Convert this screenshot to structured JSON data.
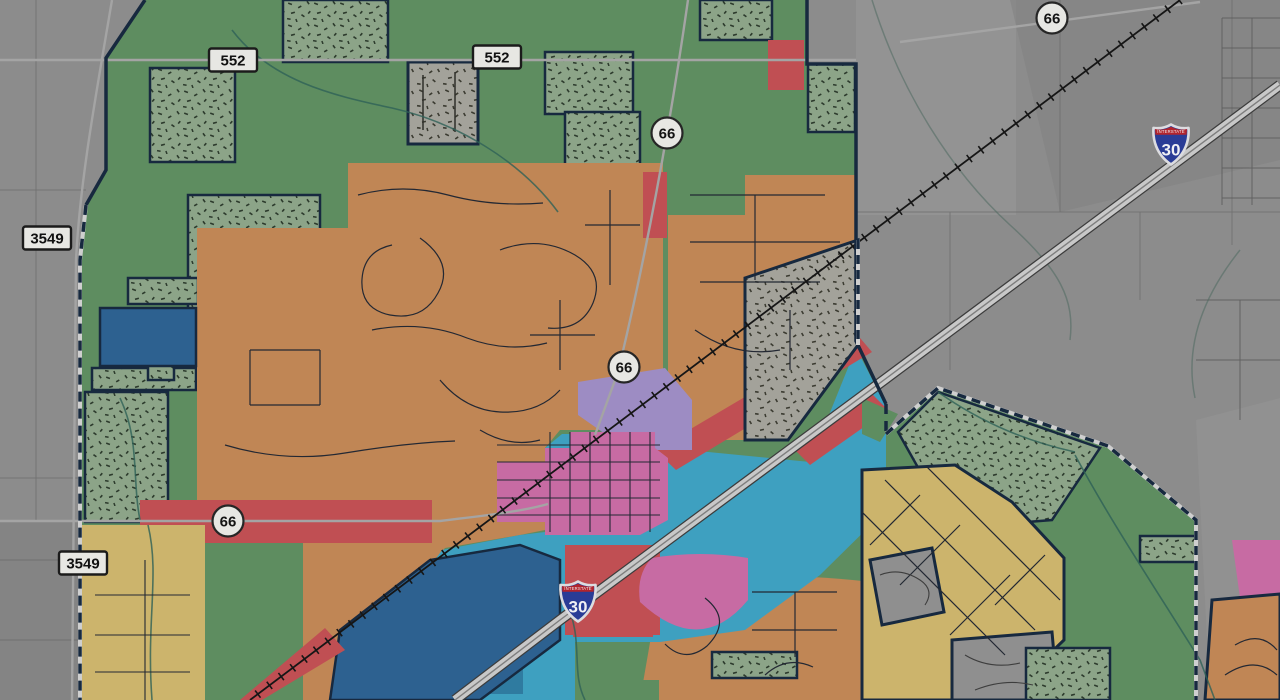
{
  "map": {
    "kind": "municipal zoning map over aerial imagery",
    "canvas": {
      "width": 1280,
      "height": 700
    },
    "highway_shields": {
      "rectangular": [
        {
          "label": "552",
          "x": 233,
          "y": 60
        },
        {
          "label": "552",
          "x": 497,
          "y": 57
        },
        {
          "label": "3549",
          "x": 47,
          "y": 238
        },
        {
          "label": "3549",
          "x": 83,
          "y": 563
        }
      ],
      "circular": [
        {
          "label": "66",
          "x": 1052,
          "y": 18
        },
        {
          "label": "66",
          "x": 667,
          "y": 133
        },
        {
          "label": "66",
          "x": 624,
          "y": 367
        },
        {
          "label": "66",
          "x": 228,
          "y": 521
        }
      ],
      "interstate": [
        {
          "label": "30",
          "caption": "INTERSTATE",
          "x": 1171,
          "y": 144
        },
        {
          "label": "30",
          "caption": "INTERSTATE",
          "x": 578,
          "y": 601
        }
      ]
    },
    "palette": {
      "aerial_gray": "#8c8c8c",
      "zone_green": "#5e8d60",
      "zone_green_speckled_base": "#8ca488",
      "zone_gray_speckled_base": "#a3a29a",
      "zone_orange": "#c08655",
      "zone_red": "#c04f53",
      "zone_cyan": "#3ea0c0",
      "zone_dark_blue": "#2d6190",
      "zone_pink": "#c76ba3",
      "zone_purple": "#9d8cc3",
      "zone_tan": "#ccb46c",
      "city_boundary_navy": "#17293f",
      "street_line": "#232833",
      "stream_teal": "#2e6157",
      "railroad_black": "#161616",
      "interstate_pavement": "#c8c8c8",
      "shield_face": "#e7e7e3",
      "interstate_shield_blue": "#2a3c96",
      "interstate_shield_red": "#b2242d"
    }
  }
}
